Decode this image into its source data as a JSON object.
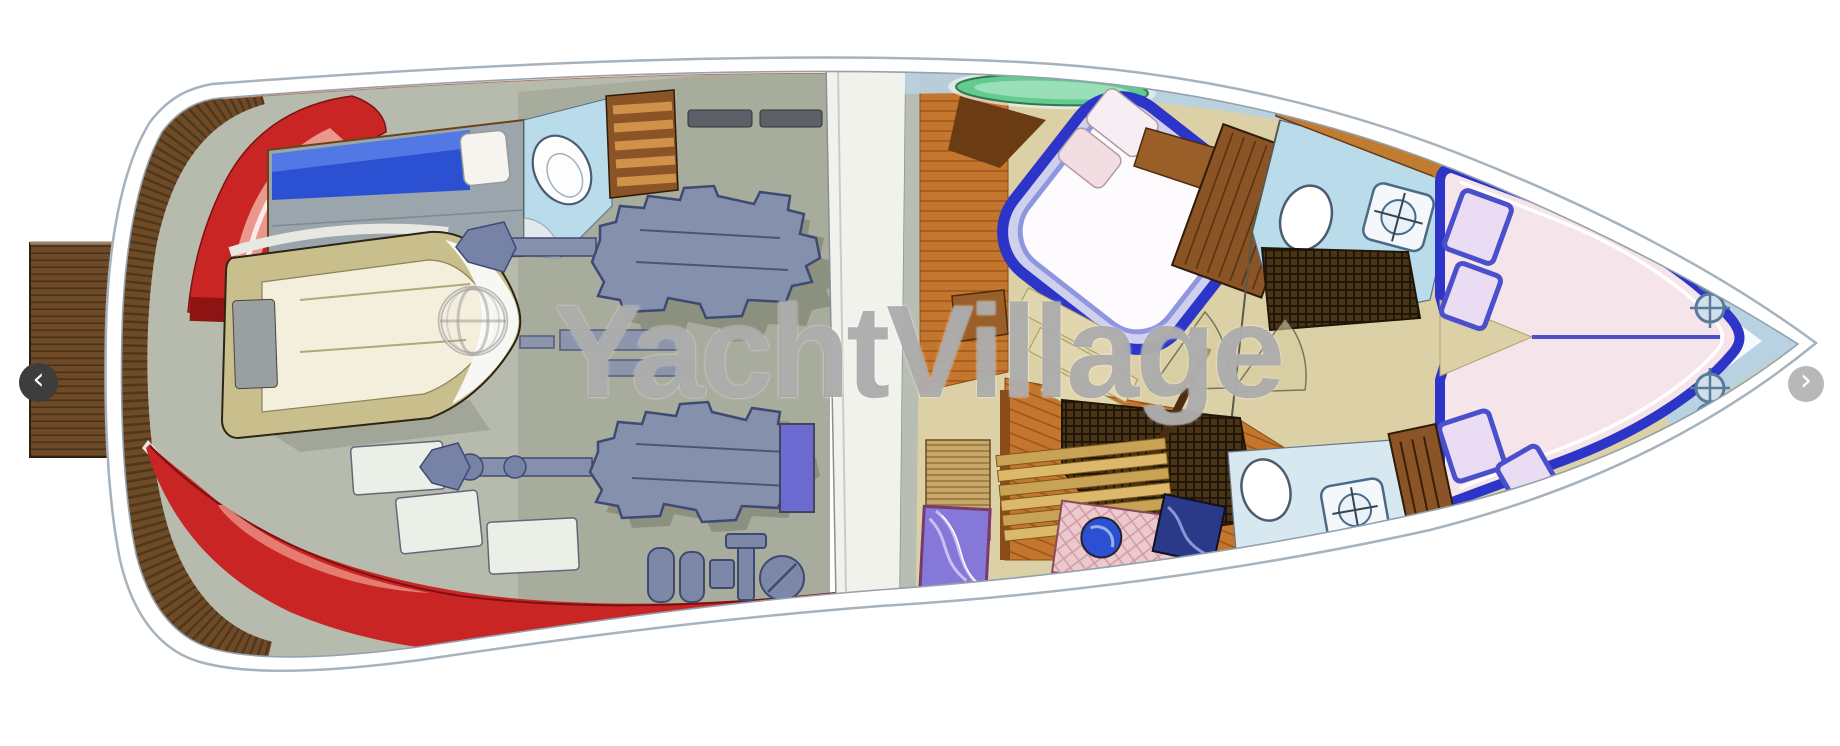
{
  "page": {
    "width": 1840,
    "height": 746,
    "background": "#ffffff"
  },
  "watermark": {
    "icon": "globe-copyright-icon",
    "text": "YachtVillage",
    "color": "#5f5f5f",
    "opacity": 0.5
  },
  "carousel": {
    "prev": {
      "label": "previous image",
      "glyph": "‹",
      "background": "#3d3d3d"
    },
    "next": {
      "label": "next image",
      "glyph": "›",
      "background": "#b8b8b8"
    }
  },
  "palette": {
    "hull_outline": "#a6b2bc",
    "hull_inner_line": "#93a2ad",
    "hull_red": "#c92525",
    "hull_red_dark": "#8e1414",
    "hull_red_light": "#ee9a8c",
    "hull_pink": "#eec3b5",
    "platform_wood": "#6e4a26",
    "cockpit_gray": "#b6bbae",
    "engine_room_gray": "#a8ac9d",
    "engine_blue": "#8590ac",
    "engine_outline": "#3f4a72",
    "tender_trim": "#c9bf8c",
    "tender_inner": "#f4eedc",
    "berth_blue": "#2c50d2",
    "bath_blue": "#b9dbea",
    "cabinet_wood": "#8a5426",
    "cabinet_stripe": "#cf9248",
    "bulkhead_white": "#f2f2ed",
    "floor_tan": "#dbd0a6",
    "floor_wood": "#c5762e",
    "bed_blue": "#2c35c8",
    "bed_white": "#fdfbfd",
    "pillow_pink": "#f2dde2",
    "vberth_pink": "#f5e4ea",
    "glass_blue": "#b8d2e2",
    "beam_wood": "#c07c30",
    "hatch_green": "#4cbf7e",
    "tub_green": "#63ca90",
    "mat_dark": "#4a3416",
    "marble_purple": "#8678d8",
    "marble_pink": "#ecc9cd",
    "counter_green": "#66c892",
    "cooktop_blue": "#2a3a88",
    "stair_gold": "#c8a355"
  },
  "floorplan": {
    "kind": "yacht-interior-deck-plan-illustration",
    "orientation": "bow-right-stern-left",
    "regions": [
      {
        "name": "swim-platform",
        "fill": "#6e4a26"
      },
      {
        "name": "stern-teak-deck",
        "fill": "#6e4a26"
      },
      {
        "name": "stern-red-hull",
        "fill": "#c92525"
      },
      {
        "name": "bottom-red-hull",
        "fill": "#c92525"
      },
      {
        "name": "cockpit",
        "fill": "#b6bbae"
      },
      {
        "name": "tender-dinghy",
        "fill": "#f4eedc"
      },
      {
        "name": "crew-berth",
        "fill": "#2c50d2"
      },
      {
        "name": "aft-head",
        "fill": "#b9dbea"
      },
      {
        "name": "engine-room",
        "fill": "#a8ac9d"
      },
      {
        "name": "bulkhead-walkway",
        "fill": "#f2f2ed"
      },
      {
        "name": "master-cabin",
        "fill": "#dbd0a6"
      },
      {
        "name": "master-bed",
        "fill": "#fdfbfd"
      },
      {
        "name": "wardrobe",
        "fill": "#8a5426"
      },
      {
        "name": "mid-head",
        "fill": "#b9dbea"
      },
      {
        "name": "companionway-stairs",
        "fill": "#c8a355"
      },
      {
        "name": "galley",
        "fill": "#ecc9cd"
      },
      {
        "name": "lower-head",
        "fill": "#d8e8f0"
      },
      {
        "name": "v-berth-cabin",
        "fill": "#f5e4ea"
      },
      {
        "name": "bow-deck",
        "fill": "#b8d2e2"
      }
    ],
    "features": {
      "portholes": 4,
      "engines": 2,
      "toilets": 3,
      "sinks": 3,
      "green_deck_hatches": 2,
      "berth_areas": [
        "crew-berth",
        "master-bed",
        "v-berth"
      ]
    }
  }
}
